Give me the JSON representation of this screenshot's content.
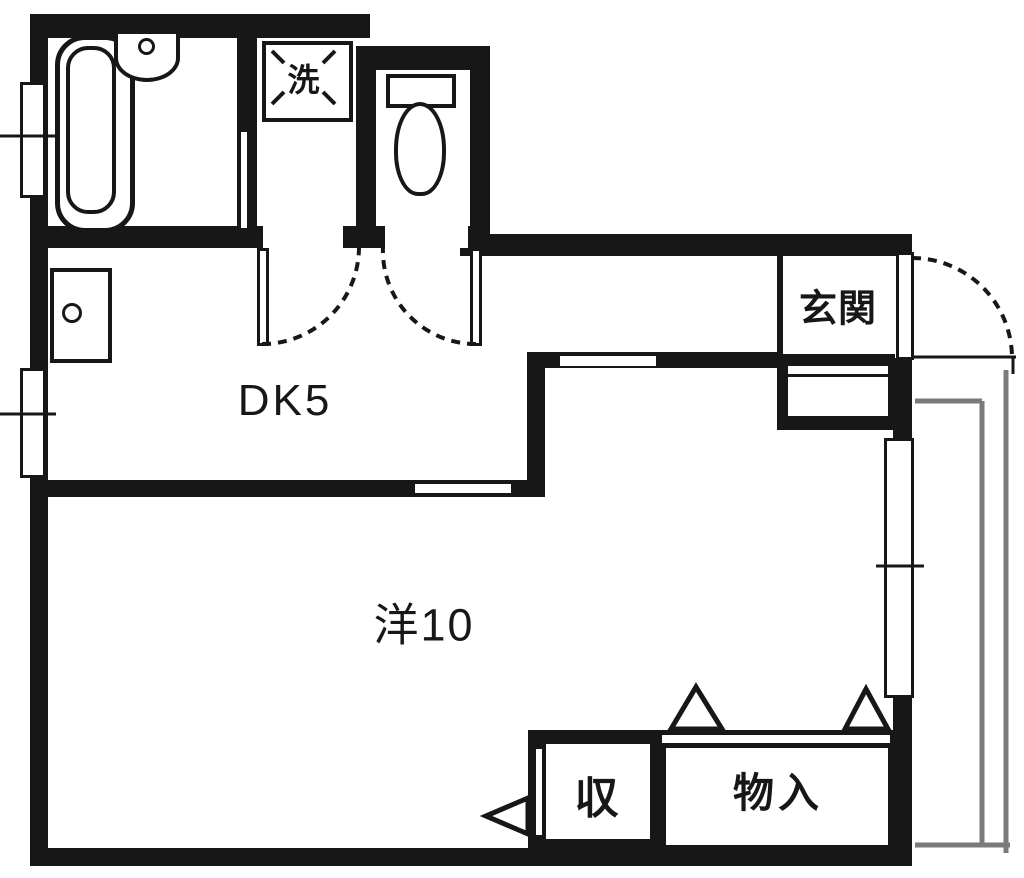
{
  "floorplan": {
    "labels": {
      "dk": "DK5",
      "living": "洋10",
      "entrance": "玄関",
      "laundry": "洗",
      "storage": "収",
      "closet": "物入"
    },
    "colors": {
      "wall": "#171717",
      "background": "#ffffff",
      "balcony_rail": "#7a7a7a"
    }
  }
}
